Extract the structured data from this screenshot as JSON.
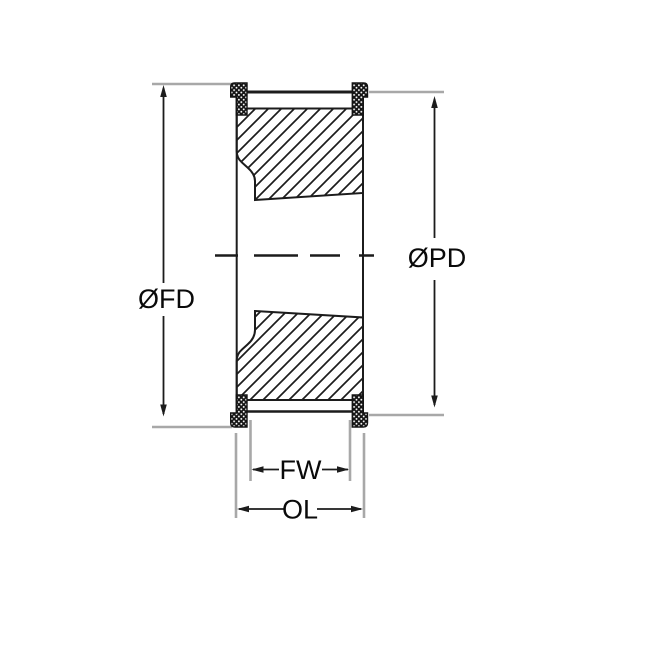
{
  "diagram": {
    "labels": {
      "flange_diameter": "ØFD",
      "pitch_diameter": "ØPD",
      "face_width": "FW",
      "overall_length": "OL"
    },
    "colors": {
      "line": "#1c1c1c",
      "extension": "#a8a8a8",
      "text": "#0a0a0a",
      "background": "#ffffff"
    }
  }
}
